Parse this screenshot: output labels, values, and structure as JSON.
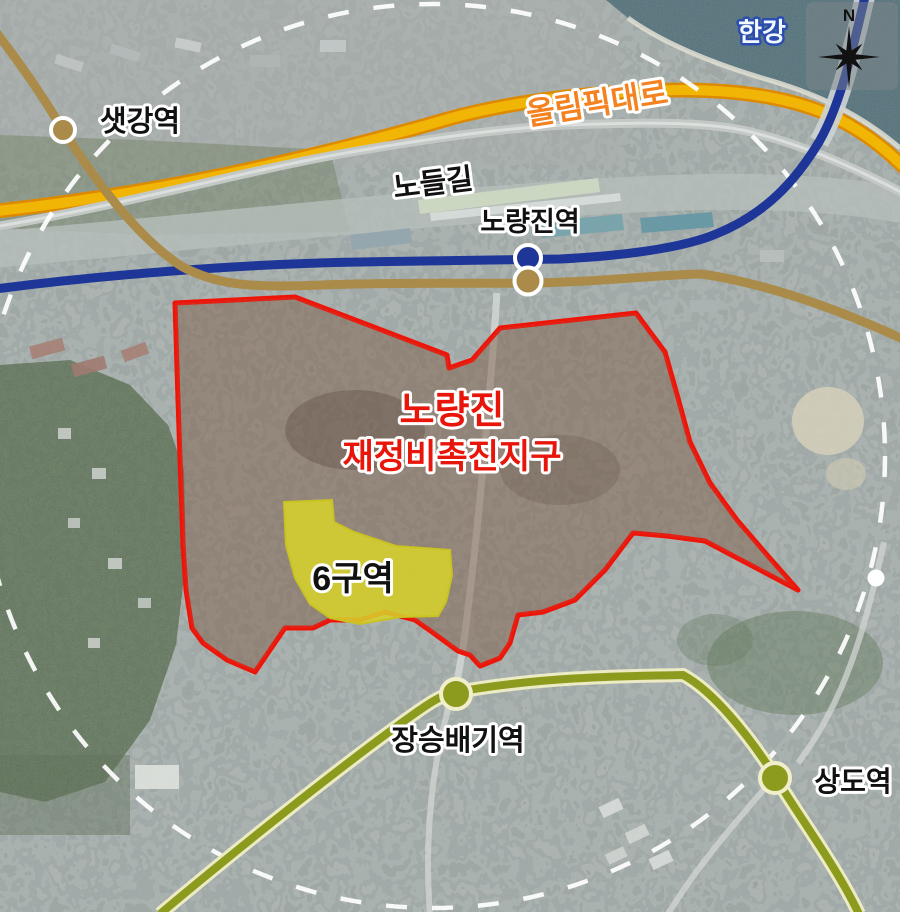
{
  "map": {
    "compass": {
      "north_label": "N"
    },
    "river": {
      "label": "한강"
    },
    "roads": {
      "olympic": {
        "label": "올림픽대로"
      },
      "nodeul": {
        "label": "노들길"
      }
    },
    "district": {
      "title_line1": "노량진",
      "title_line2": "재정비촉진지구"
    },
    "zone6": {
      "label": "6구역"
    },
    "stations": [
      {
        "id": "saetgang",
        "label": "샛강역"
      },
      {
        "id": "noryangjin",
        "label": "노량진역"
      },
      {
        "id": "jangseungbaegi",
        "label": "장승배기역"
      },
      {
        "id": "sangdo",
        "label": "상도역"
      }
    ],
    "colors": {
      "district_boundary": "#ee1408",
      "district_label_red": "#e8150a",
      "zone6_fill": "#d8d32a",
      "line1_blue": "#1e3698",
      "line9_tan": "#ab8b49",
      "line7_olive": "#8c9b1e",
      "olympic_road_yellow": "#f1b505",
      "olympic_label_orange": "#f58220",
      "radius_circle": "#ffffff"
    }
  }
}
